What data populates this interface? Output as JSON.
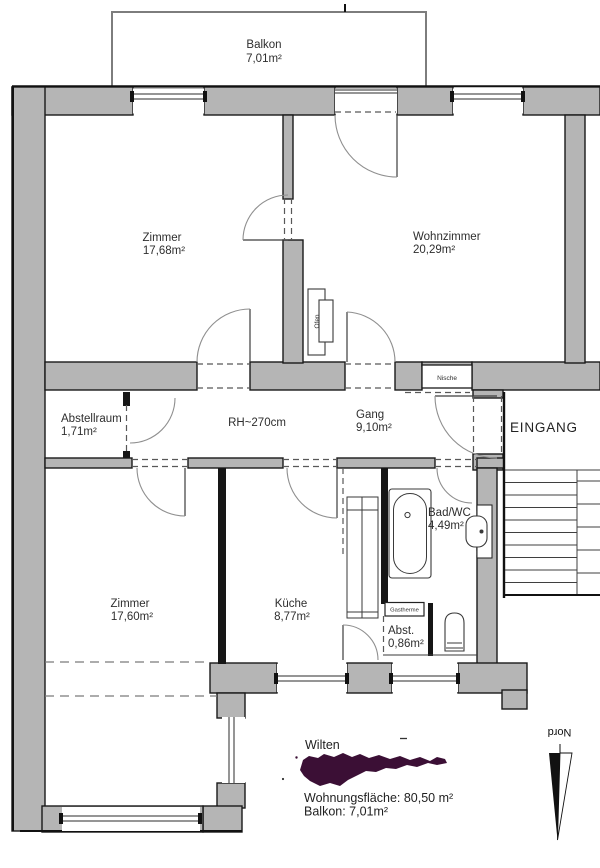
{
  "rooms": {
    "balkon": {
      "name": "Balkon",
      "area": "7,01m²"
    },
    "zimmer1": {
      "name": "Zimmer",
      "area": "17,68m²"
    },
    "wohnzimmer": {
      "name": "Wohnzimmer",
      "area": "20,29m²"
    },
    "abstellraum": {
      "name": "Abstellraum",
      "area": "1,71m²"
    },
    "gang": {
      "name": "Gang",
      "area": "9,10m²"
    },
    "zimmer2": {
      "name": "Zimmer",
      "area": "17,60m²"
    },
    "kueche": {
      "name": "Küche",
      "area": "8,77m²"
    },
    "bad": {
      "name": "Bad/WC",
      "area": "4,49m²"
    },
    "abst": {
      "name": "Abst.",
      "area": "0,86m²"
    }
  },
  "annotations": {
    "room_height": "RH~270cm",
    "entrance": "EINGANG",
    "niche": "Nische",
    "stove": "Ofen",
    "boiler": "Gastherme"
  },
  "compass": {
    "north_label": "Nord"
  },
  "footer": {
    "district": "Wilten",
    "living_area": "Wohnungsfläche: 80,50 m²",
    "balcony_area": "Balkon: 7,01m²"
  },
  "colors": {
    "wall": "#b5b5b5",
    "wall-dark": "#161616",
    "district-blob": "#3b0f35",
    "text": "#2e2e2e"
  }
}
